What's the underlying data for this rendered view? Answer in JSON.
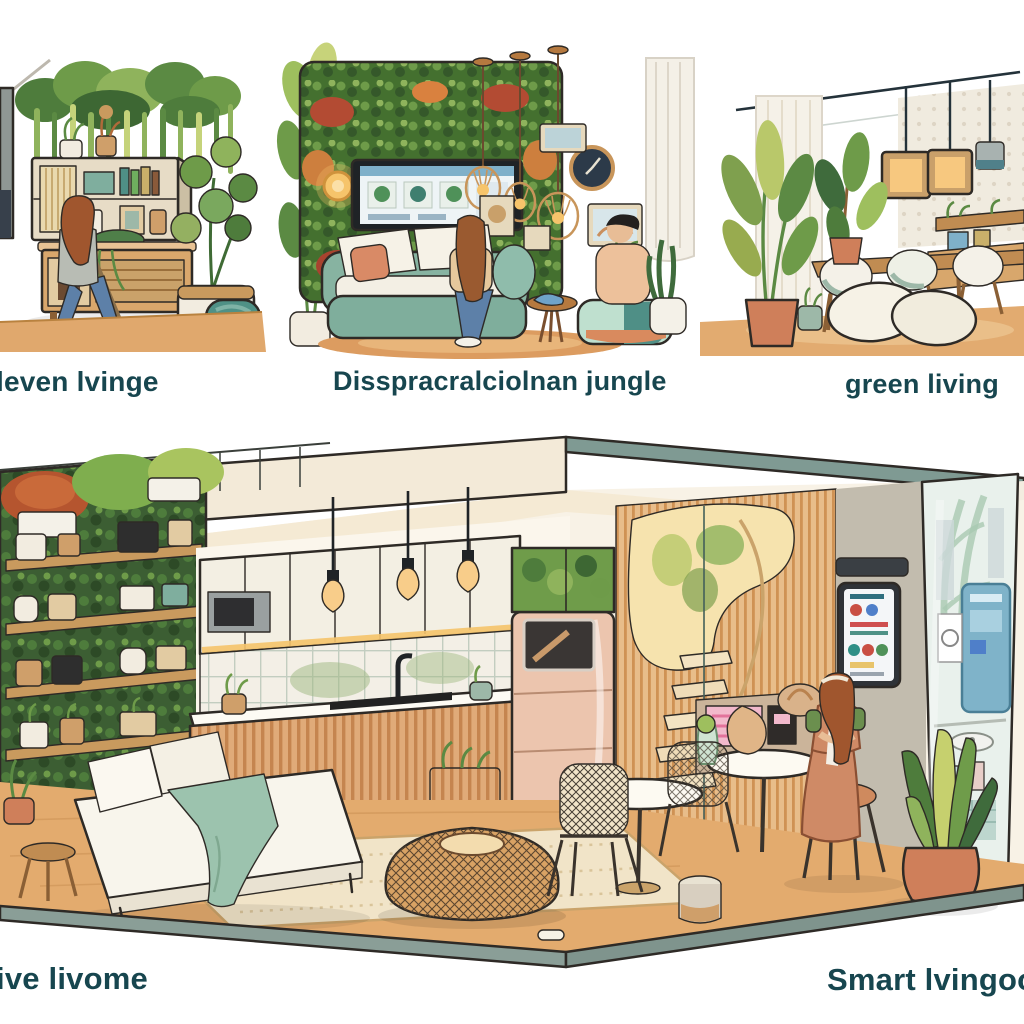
{
  "captions": {
    "panel1": "leven lvinge",
    "panel2": "Disspracralciolnan jungle",
    "panel3": "green living",
    "bottom_left": "ive livome",
    "bottom_right": "Smart lvingoom"
  },
  "palette": {
    "caption_text": "#17464f",
    "leaf_green": "#6e9b49",
    "dark_leaf": "#3f6b3c",
    "sage_sofa": "#87b3a1",
    "teal_accent": "#4f8f86",
    "terracotta": "#d98a66",
    "wood": "#d9a368",
    "wood_dark": "#b9823f",
    "blush_appliance": "#ecc5ae",
    "cream_ceiling": "#f3ead8",
    "beam_sage": "#7f9a93",
    "flower_red": "#b34b33",
    "flower_orange": "#cd7f3e",
    "outline": "#2e2a26",
    "floor": "#e3ab6e",
    "screen_pink": "#f2b9cc",
    "screen_blue": "#7fb3c9"
  }
}
